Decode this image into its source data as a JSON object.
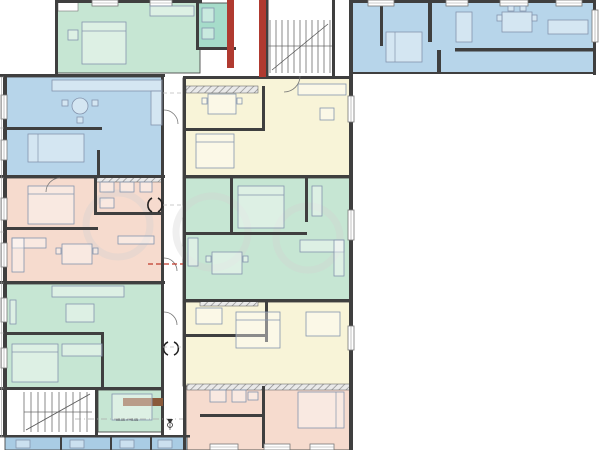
{
  "plan": {
    "title": "apartment-building-floor-plan",
    "elevation_label": "±0.00 = +0.05",
    "palette": {
      "green": "#c6e6d3",
      "teal": "#a6dcca",
      "blue": "#b7d5ea",
      "blue_dark": "#a9cce4",
      "pink": "#f6dbce",
      "cream": "#f8f4d8",
      "wall": "#3f3f3f",
      "red_wall": "#b03a30",
      "brown": "#8a5a3b",
      "dim_line": "#9a9a9a",
      "furniture_line": "#8494ad",
      "dashed_red": "#c0392b"
    },
    "regions": [
      {
        "name": "apt-top-left-green",
        "color": "green",
        "x": 57,
        "y": 2,
        "w": 143,
        "h": 71
      },
      {
        "name": "utility-room-teal",
        "color": "teal",
        "x": 198,
        "y": 3,
        "w": 30,
        "h": 45
      },
      {
        "name": "apt-top-right-blue",
        "color": "blue",
        "x": 352,
        "y": 2,
        "w": 243,
        "h": 71
      },
      {
        "name": "apt-left-blue",
        "color": "blue",
        "x": 6,
        "y": 77,
        "w": 157,
        "h": 100
      },
      {
        "name": "apt-left-pink",
        "color": "pink",
        "x": 6,
        "y": 178,
        "w": 157,
        "h": 105
      },
      {
        "name": "apt-left-green",
        "color": "green",
        "x": 6,
        "y": 284,
        "w": 157,
        "h": 105
      },
      {
        "name": "room-green-lower",
        "color": "green",
        "x": 98,
        "y": 390,
        "w": 65,
        "h": 42
      },
      {
        "name": "apt-center-cream-upper",
        "color": "cream",
        "x": 183,
        "y": 78,
        "w": 169,
        "h": 100
      },
      {
        "name": "apt-center-green",
        "color": "green",
        "x": 183,
        "y": 178,
        "w": 169,
        "h": 124
      },
      {
        "name": "apt-center-cream-lower",
        "color": "cream",
        "x": 183,
        "y": 302,
        "w": 169,
        "h": 84
      },
      {
        "name": "apt-center-pink",
        "color": "pink",
        "x": 186,
        "y": 386,
        "w": 166,
        "h": 64
      },
      {
        "name": "bottom-blue-strip",
        "color": "blue_dark",
        "x": 5,
        "y": 437,
        "w": 182,
        "h": 13
      }
    ],
    "windows": [
      {
        "x": 1,
        "y": 95,
        "w": 6,
        "h": 24
      },
      {
        "x": 1,
        "y": 140,
        "w": 6,
        "h": 20
      },
      {
        "x": 1,
        "y": 198,
        "w": 6,
        "h": 22
      },
      {
        "x": 1,
        "y": 243,
        "w": 6,
        "h": 24
      },
      {
        "x": 1,
        "y": 298,
        "w": 6,
        "h": 24
      },
      {
        "x": 1,
        "y": 348,
        "w": 6,
        "h": 20
      },
      {
        "x": 92,
        "y": 0,
        "w": 26,
        "h": 6
      },
      {
        "x": 150,
        "y": 0,
        "w": 22,
        "h": 6
      },
      {
        "x": 368,
        "y": 0,
        "w": 26,
        "h": 6
      },
      {
        "x": 446,
        "y": 0,
        "w": 22,
        "h": 6
      },
      {
        "x": 500,
        "y": 0,
        "w": 28,
        "h": 6
      },
      {
        "x": 556,
        "y": 0,
        "w": 26,
        "h": 6
      },
      {
        "x": 592,
        "y": 10,
        "w": 6,
        "h": 32
      },
      {
        "x": 348,
        "y": 96,
        "w": 6,
        "h": 26
      },
      {
        "x": 348,
        "y": 210,
        "w": 6,
        "h": 30
      },
      {
        "x": 348,
        "y": 326,
        "w": 6,
        "h": 24
      },
      {
        "x": 210,
        "y": 444,
        "w": 28,
        "h": 6
      },
      {
        "x": 264,
        "y": 444,
        "w": 26,
        "h": 6
      },
      {
        "x": 310,
        "y": 444,
        "w": 24,
        "h": 6
      }
    ]
  }
}
